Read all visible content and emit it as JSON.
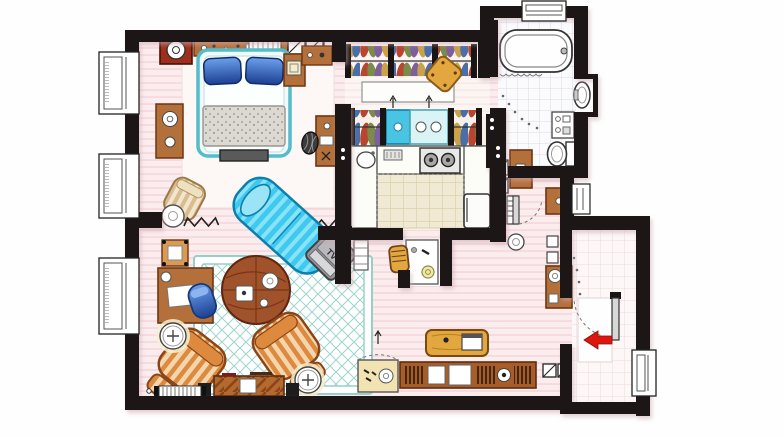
{
  "labels": {
    "tv": "TV"
  },
  "entry_arrow": {
    "direction": "left"
  },
  "rooms": [
    "bedroom",
    "walk-in-closet",
    "bathroom",
    "kitchen",
    "desk-nook",
    "hallway",
    "living-room",
    "entry"
  ],
  "furniture": [
    "double-bed",
    "blue-pillows",
    "nightstand",
    "dresser-with-lamp",
    "wall-shelf",
    "hatched-storage",
    "clothes-rack",
    "closet-island",
    "closet-ottoman",
    "blue-drawer-unit",
    "bathtub",
    "bathroom-sink",
    "toilet",
    "bath-cabinet",
    "kitchen-counter",
    "stove",
    "kitchen-sink",
    "fridge",
    "writing-desk",
    "desk-chair",
    "chaise-lounge",
    "tv-stand",
    "area-rug",
    "round-coffee-table",
    "striped-armchair",
    "vanity-desk",
    "vanity-chair",
    "side-table-lamp",
    "media-console",
    "speaker",
    "radiator",
    "bookshelf",
    "shoe-cabinet",
    "bench-with-laptop",
    "console-table",
    "entry-door",
    "entry-mat",
    "window",
    "entrance-arrow"
  ],
  "colors": {
    "wall": "#1a1515",
    "floor-pink": "#fbecee",
    "floor-stripe": "#f3d2d8",
    "floor-light": "#fdf8f5",
    "tile-beige": "#f0e9d4",
    "tile-line-beige": "#dbd1ac",
    "tile-white": "#fbfbfd",
    "tile-line-gray": "#dadbe2",
    "tile-line-pink": "#eddadf",
    "rug-teal": "#96cfc8",
    "bed-teal": "#55bccb",
    "pillow-blue-1": "#6aa0ec",
    "pillow-blue-2": "#1c3f92",
    "chaise-cyan": "#3ec9ee",
    "chaise-stripe": "#8ae2f6",
    "chaise-dark": "#0c7fae",
    "wood": "#b4703a",
    "wood-dark": "#6e3413",
    "wood-red": "#9e2f1d",
    "wood-light": "#d89a55",
    "wood-gold": "#e2a83f",
    "orange": "#dd8a3e",
    "orange-stripe": "#f3d6ae",
    "orange-dark": "#8a4517",
    "cream": "#f1e6cc",
    "cream-stripe": "#d9bc90",
    "blue-cab": "#49c4e2",
    "tv-gray": "#97979b",
    "tv-dark": "#3f3f44",
    "arrow-red": "#dc1710",
    "ink": "#222222"
  }
}
